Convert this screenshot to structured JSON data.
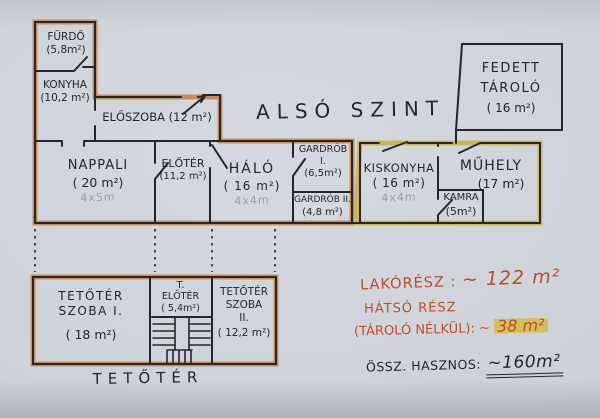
{
  "title": "ALSÓ SZINT",
  "lower_level": {
    "rooms": {
      "furdo": {
        "name": "FÜRDŐ",
        "area": "(5,8m²)"
      },
      "konyha": {
        "name": "KONYHA",
        "area": "(10,2 m²)"
      },
      "eloszoba": {
        "name": "ELŐSZOBA",
        "area": "(12 m²)"
      },
      "nappali": {
        "name": "NAPPALI",
        "area": "( 20 m²)",
        "pencil_note": "4x5m"
      },
      "eloter": {
        "name": "ELŐTÉR",
        "area": "(11,2 m²)"
      },
      "halo": {
        "name": "HÁLÓ",
        "area": "( 16 m²)",
        "pencil_note": "4x4m"
      },
      "gardrob_1": {
        "name": "GARDRÓB",
        "numeral": "I.",
        "area": "(6,5m²)"
      },
      "gardrob_2": {
        "name": "GARDRÓB II.",
        "area": "(4,8 m²)"
      },
      "kiskonyha": {
        "name": "KISKONYHA",
        "area": "( 16 m²)",
        "pencil_note": "4x4m"
      },
      "kamra": {
        "name": "KAMRA",
        "area": "(5m²)"
      },
      "muhely": {
        "name": "MŰHELY",
        "area": "(17 m²)"
      },
      "fedett_tarolo": {
        "line1": "FEDETT",
        "line2": "TÁROLÓ",
        "area": "( 16 m²)"
      }
    }
  },
  "attic": {
    "label": "TETŐTÉR",
    "rooms": {
      "szoba_1": {
        "line1": "TETŐTÉR",
        "line2": "SZOBA I.",
        "area": "( 18 m²)"
      },
      "t_eloter": {
        "line1": "T.",
        "line2": "ELŐTÉR",
        "area": "( 5,4m²)"
      },
      "szoba_2": {
        "line1": "TETŐTÉR",
        "line2": "SZOBA",
        "line3": "II.",
        "area": "( 12,2 m²)"
      }
    }
  },
  "annotations": {
    "lakoresz_label": "LAKÓRÉSZ :",
    "lakoresz_value": "~ 122 m²",
    "hatso_line1": "HÁTSÓ RÉSZ",
    "hatso_line2": "(TÁROLÓ NÉLKÜL): ~",
    "hatso_value": "38 m²",
    "ossz_label": "ÖSSZ. HASZNOS:",
    "ossz_value": "~160m²"
  },
  "colors": {
    "paper": "#ced3da",
    "ink": "#26262a",
    "outer_wall_highlight_main": "#c8854b",
    "outer_wall_highlight_rear": "#c9b14e",
    "annotation_ink": "#bf4c28",
    "highlight_yellow": "#d7b93c",
    "pencil": "#96a0ad"
  }
}
